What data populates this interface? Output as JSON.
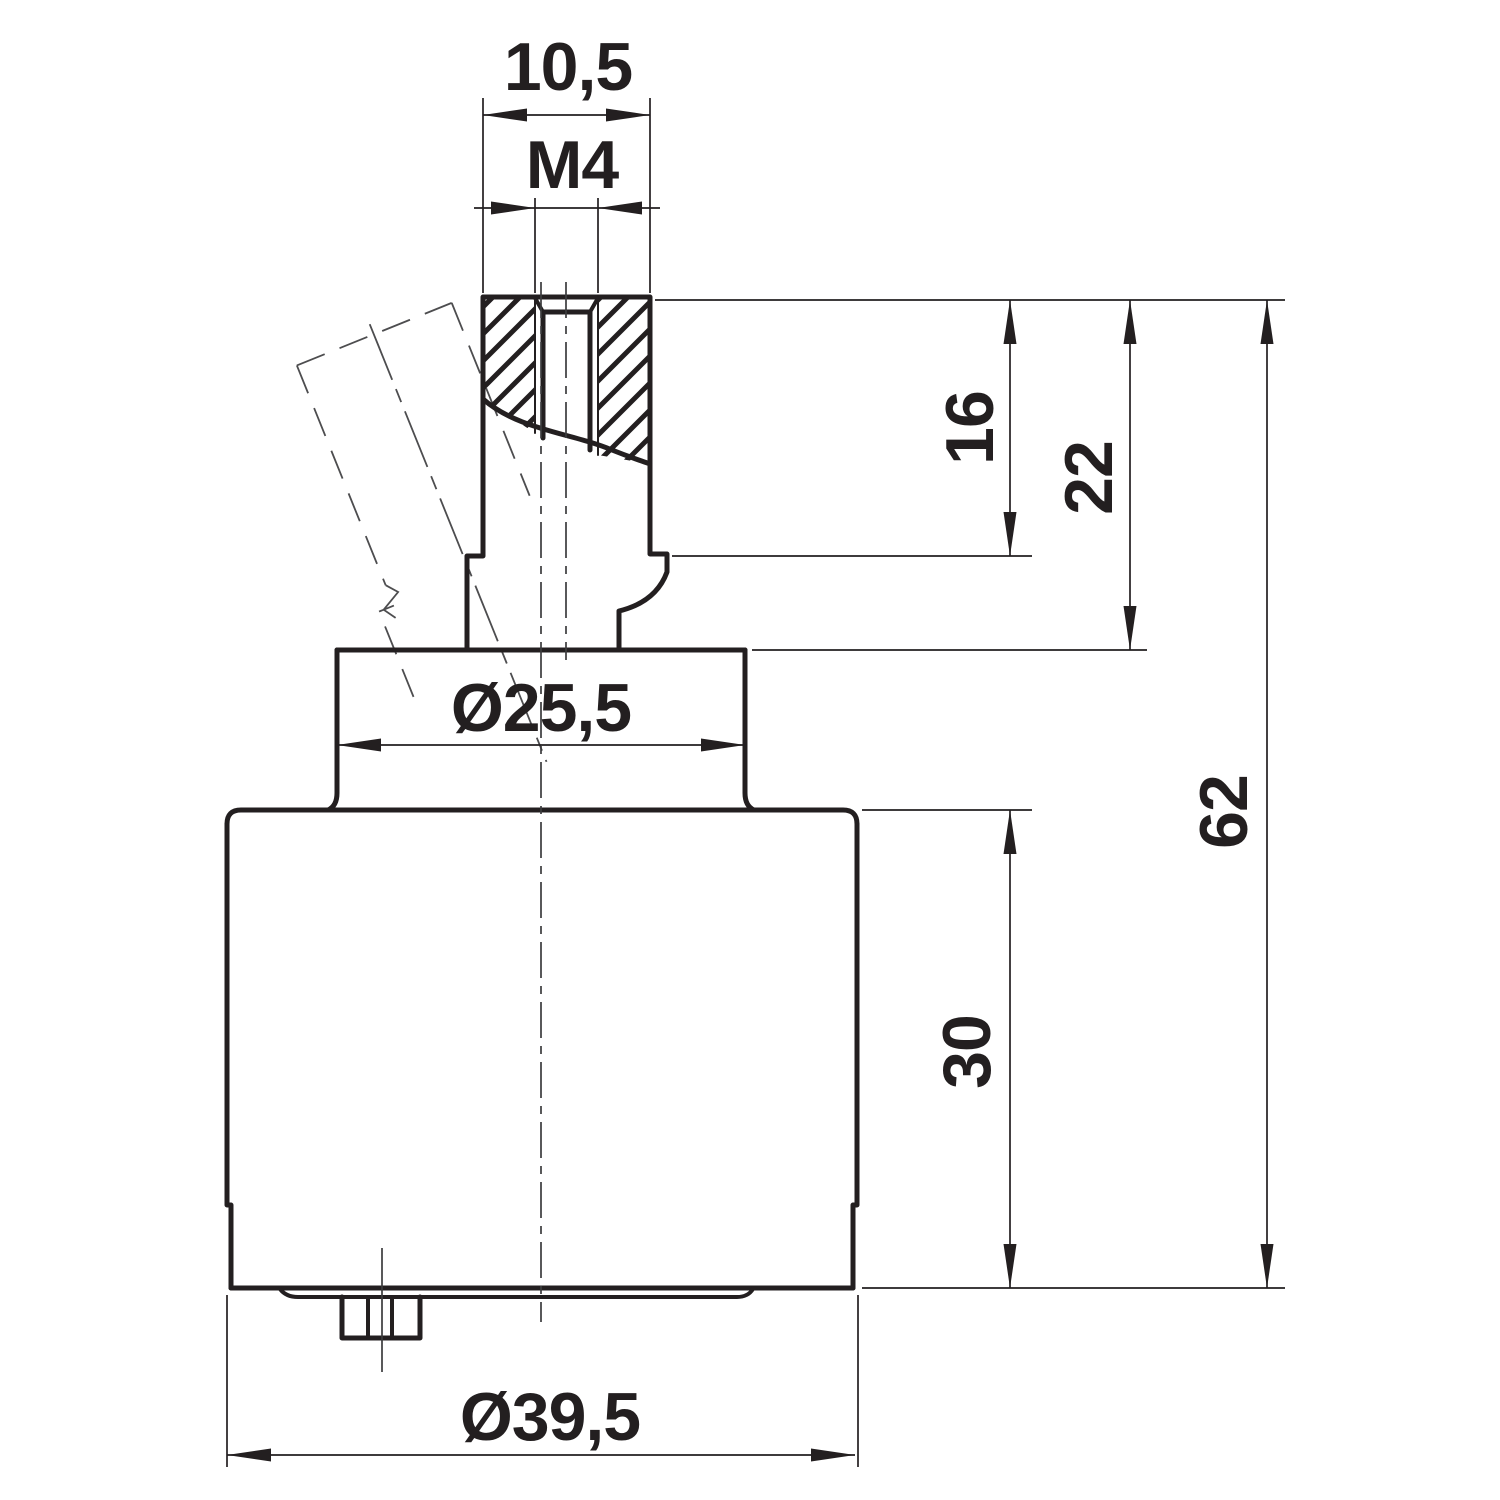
{
  "drawing": {
    "background": "#ffffff",
    "ink": "#231f20",
    "phantom": "#4d4d4f",
    "dimensions": {
      "spindle_width": {
        "label": "10,5",
        "value": 10.5
      },
      "thread": {
        "label": "M4"
      },
      "spindle_step_height": {
        "label": "16",
        "value": 16
      },
      "spindle_full_height": {
        "label": "22",
        "value": 22
      },
      "collar_diameter": {
        "label": "Ø25,5",
        "value": 25.5
      },
      "overall_height": {
        "label": "62",
        "value": 62
      },
      "body_height": {
        "label": "30",
        "value": 30
      },
      "body_diameter": {
        "label": "Ø39,5",
        "value": 39.5
      }
    }
  }
}
